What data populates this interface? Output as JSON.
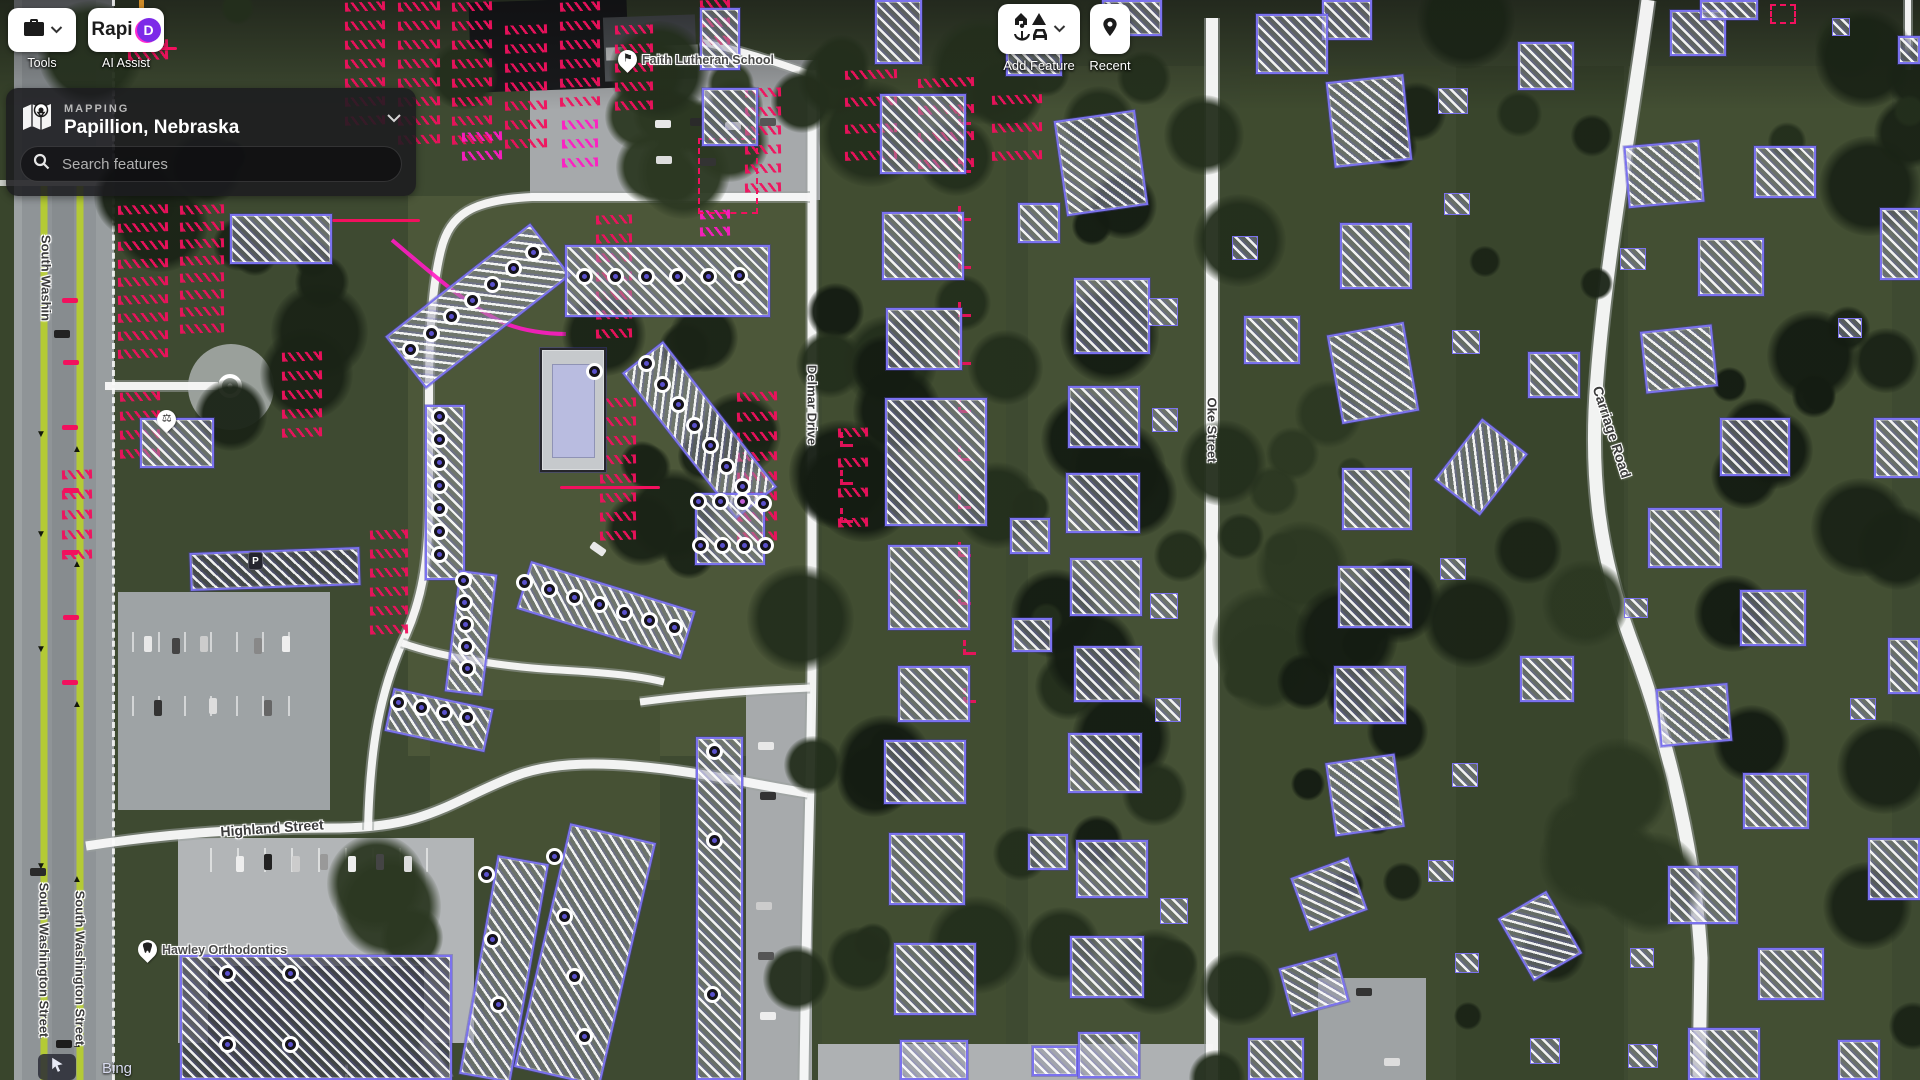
{
  "toolbar": {
    "tools": {
      "label": "Tools"
    },
    "rapid": {
      "logo_text": "Rapi",
      "logo_d": "D",
      "label": "AI Assist"
    },
    "add_feature": {
      "label": "Add Feature"
    },
    "recent": {
      "label": "Recent"
    }
  },
  "panel": {
    "section": "MAPPING",
    "title": "Papillion, Nebraska",
    "search_placeholder": "Search features"
  },
  "attribution": {
    "source": "Bing"
  },
  "map": {
    "colors": {
      "osm_purple": "#7b72ee",
      "ai_red": "#f1115e",
      "ai_magenta": "#ff1cc3",
      "node_fill": "#5a50cc",
      "road_lime": "#b6cc2f",
      "road_white": "#f8f8f8"
    },
    "street_labels": [
      {
        "text": "South Washin",
        "x": 46,
        "y": 278,
        "rot": 90,
        "size": 13
      },
      {
        "text": "South Washington Street",
        "x": 44,
        "y": 960,
        "rot": 90,
        "size": 13
      },
      {
        "text": "South Washington Street",
        "x": 80,
        "y": 968,
        "rot": 90,
        "size": 13
      },
      {
        "text": "Highland Street",
        "x": 272,
        "y": 828,
        "rot": -4,
        "size": 14
      },
      {
        "text": "Delmar Drive",
        "x": 812,
        "y": 405,
        "rot": 90,
        "size": 13
      },
      {
        "text": "Oke Street",
        "x": 1212,
        "y": 430,
        "rot": 90,
        "size": 13
      },
      {
        "text": "Carriage Road",
        "x": 1612,
        "y": 432,
        "rot": 72,
        "size": 14
      }
    ],
    "pois": [
      {
        "label": "Faith Lutheran School",
        "x": 618,
        "y": 50,
        "icon": "school"
      },
      {
        "label": "Hawley Orthodontics",
        "x": 138,
        "y": 940,
        "icon": "tooth"
      },
      {
        "label": "",
        "x": 157,
        "y": 410,
        "icon": "scales"
      },
      {
        "label": "P",
        "x": 248,
        "y": 552,
        "icon": "parking"
      }
    ],
    "roads": [
      {
        "name": "delmar-drive",
        "d": "M812,70 L812,650 C812,760 806,900 804,1080",
        "w": 9
      },
      {
        "name": "oke-street",
        "d": "M1212,18 L1212,1080",
        "w": 12
      },
      {
        "name": "carriage-road",
        "d": "M1648,0 C1632,120 1606,258 1597,378 C1589,478 1599,556 1633,646 C1669,742 1696,858 1701,958 L1699,1080",
        "w": 13
      },
      {
        "name": "highland-street",
        "d": "M86,846 C170,833 250,828 340,828 C430,827 452,800 515,776 C562,758 625,764 672,770 C732,778 772,788 808,793",
        "w": 9
      },
      {
        "name": "complex-loop",
        "d": "M810,197 L532,197 C472,200 450,214 441,250 C433,282 429,330 429,392 L429,500 C429,560 422,602 402,643 C381,692 370,742 368,830",
        "w": 8
      },
      {
        "name": "entrance-road",
        "d": "M105,386 L218,386",
        "w": 8
      },
      {
        "name": "lot-entrance",
        "d": "M640,702 C700,694 760,690 810,688",
        "w": 7
      },
      {
        "name": "complex-cross",
        "d": "M402,643 C450,660 520,668 560,670 C610,673 640,676 664,682",
        "w": 7
      },
      {
        "name": "south-road",
        "d": "M398,1012 C418,1036 436,1060 446,1080",
        "w": 13
      },
      {
        "name": "school-stub",
        "d": "M812,75 C770,60 740,50 700,42",
        "w": 7
      },
      {
        "name": "edge-road",
        "d": "M1908,0 L1908,70",
        "w": 6
      }
    ],
    "lime_lines": [
      {
        "d": "M44,186 L44,1080",
        "w": 7
      },
      {
        "d": "M80,186 L80,1080",
        "w": 7
      }
    ],
    "magenta_lines": [
      {
        "d": "M392,240 C430,272 468,306 502,322 C522,331 548,334 566,334",
        "w": 4
      }
    ],
    "roundabout": {
      "cx": 230,
      "cy": 386,
      "r": 10
    },
    "buildings": [
      [
        386,
        273,
        184,
        66,
        -38,
        "b"
      ],
      [
        565,
        245,
        205,
        72,
        0,
        "b"
      ],
      [
        425,
        405,
        40,
        175,
        0,
        "b"
      ],
      [
        607,
        404,
        185,
        52,
        52,
        "b"
      ],
      [
        695,
        493,
        70,
        72,
        0,
        "bn"
      ],
      [
        452,
        572,
        38,
        122,
        7,
        "b"
      ],
      [
        520,
        585,
        172,
        50,
        17,
        "b"
      ],
      [
        388,
        698,
        102,
        44,
        12,
        "b"
      ],
      [
        696,
        737,
        47,
        343,
        0,
        "b"
      ],
      [
        541,
        830,
        88,
        250,
        13,
        "b"
      ],
      [
        478,
        858,
        52,
        222,
        10,
        "b"
      ],
      [
        180,
        955,
        272,
        125,
        0,
        "b roof"
      ],
      [
        190,
        550,
        170,
        38,
        -2,
        "b roof"
      ],
      [
        230,
        214,
        102,
        50,
        0,
        "b"
      ],
      [
        140,
        418,
        74,
        50,
        0,
        "b"
      ],
      [
        875,
        0,
        47,
        64,
        0,
        "bp"
      ],
      [
        700,
        8,
        40,
        62,
        0,
        "bp"
      ],
      [
        702,
        88,
        56,
        58,
        0,
        "b"
      ],
      [
        540,
        348,
        66,
        124,
        0,
        "pool"
      ],
      [
        880,
        94,
        86,
        80,
        0,
        "b"
      ],
      [
        882,
        212,
        82,
        68,
        0,
        "b"
      ],
      [
        886,
        308,
        76,
        62,
        0,
        "b"
      ],
      [
        885,
        398,
        102,
        128,
        0,
        "bp"
      ],
      [
        888,
        545,
        82,
        85,
        0,
        "bp"
      ],
      [
        898,
        666,
        72,
        56,
        0,
        "b"
      ],
      [
        884,
        740,
        82,
        64,
        0,
        "b"
      ],
      [
        889,
        833,
        76,
        72,
        0,
        "b"
      ],
      [
        894,
        943,
        82,
        72,
        0,
        "b"
      ],
      [
        900,
        1040,
        68,
        40,
        0,
        "b"
      ],
      [
        1006,
        28,
        56,
        48,
        0,
        "b"
      ],
      [
        1018,
        203,
        42,
        40,
        0,
        "b"
      ],
      [
        1010,
        518,
        40,
        36,
        0,
        "b"
      ],
      [
        1012,
        618,
        40,
        34,
        0,
        "b"
      ],
      [
        1028,
        834,
        40,
        36,
        0,
        "b"
      ],
      [
        1032,
        1046,
        46,
        30,
        0,
        "b"
      ],
      [
        1060,
        115,
        82,
        96,
        -8,
        "b"
      ],
      [
        1074,
        278,
        76,
        76,
        0,
        "b"
      ],
      [
        1068,
        386,
        72,
        62,
        0,
        "b"
      ],
      [
        1066,
        473,
        74,
        60,
        0,
        "b"
      ],
      [
        1070,
        558,
        72,
        58,
        0,
        "b"
      ],
      [
        1074,
        646,
        68,
        56,
        0,
        "b"
      ],
      [
        1068,
        733,
        74,
        60,
        0,
        "b"
      ],
      [
        1076,
        840,
        72,
        58,
        0,
        "b"
      ],
      [
        1070,
        936,
        74,
        62,
        0,
        "b"
      ],
      [
        1078,
        1032,
        62,
        46,
        0,
        "b"
      ],
      [
        1148,
        298,
        30,
        28,
        0,
        "b sh"
      ],
      [
        1152,
        408,
        26,
        24,
        0,
        "b sh"
      ],
      [
        1150,
        593,
        28,
        26,
        0,
        "b sh"
      ],
      [
        1155,
        698,
        26,
        24,
        0,
        "b sh"
      ],
      [
        1160,
        898,
        28,
        26,
        0,
        "b sh"
      ],
      [
        1102,
        0,
        60,
        36,
        0,
        "b"
      ],
      [
        1322,
        0,
        50,
        40,
        0,
        "b"
      ],
      [
        1256,
        14,
        72,
        60,
        0,
        "b"
      ],
      [
        1330,
        78,
        78,
        86,
        -6,
        "b"
      ],
      [
        1340,
        223,
        72,
        66,
        0,
        "b"
      ],
      [
        1244,
        316,
        56,
        48,
        0,
        "b"
      ],
      [
        1334,
        328,
        78,
        90,
        -10,
        "b"
      ],
      [
        1342,
        468,
        70,
        62,
        0,
        "b"
      ],
      [
        1338,
        566,
        74,
        62,
        0,
        "b"
      ],
      [
        1334,
        666,
        72,
        58,
        0,
        "b"
      ],
      [
        1330,
        758,
        70,
        74,
        -8,
        "b"
      ],
      [
        1298,
        866,
        62,
        56,
        -20,
        "b"
      ],
      [
        1284,
        960,
        60,
        50,
        -15,
        "b"
      ],
      [
        1248,
        1038,
        56,
        42,
        0,
        "b"
      ],
      [
        1232,
        236,
        26,
        24,
        0,
        "b sh"
      ],
      [
        1438,
        88,
        30,
        26,
        0,
        "b sh"
      ],
      [
        1444,
        193,
        26,
        22,
        0,
        "b sh"
      ],
      [
        1452,
        330,
        28,
        24,
        0,
        "b sh"
      ],
      [
        1440,
        558,
        26,
        22,
        0,
        "b sh"
      ],
      [
        1452,
        763,
        26,
        24,
        0,
        "b sh"
      ],
      [
        1428,
        860,
        26,
        22,
        0,
        "b sh"
      ],
      [
        1455,
        953,
        24,
        20,
        0,
        "b sh"
      ],
      [
        1530,
        1038,
        30,
        26,
        0,
        "b sh"
      ],
      [
        1452,
        428,
        58,
        78,
        38,
        "b"
      ],
      [
        1518,
        42,
        56,
        48,
        0,
        "b"
      ],
      [
        1528,
        352,
        52,
        46,
        0,
        "b"
      ],
      [
        1520,
        656,
        54,
        46,
        0,
        "b"
      ],
      [
        1512,
        900,
        56,
        72,
        -30,
        "b"
      ],
      [
        1670,
        10,
        56,
        46,
        0,
        "b"
      ],
      [
        1700,
        0,
        58,
        20,
        0,
        "b"
      ],
      [
        1832,
        18,
        18,
        18,
        0,
        "b sh"
      ],
      [
        1898,
        36,
        22,
        28,
        0,
        "b"
      ],
      [
        1626,
        143,
        76,
        62,
        -5,
        "b"
      ],
      [
        1754,
        146,
        62,
        52,
        0,
        "b"
      ],
      [
        1698,
        238,
        66,
        58,
        0,
        "b"
      ],
      [
        1643,
        328,
        72,
        62,
        -6,
        "b"
      ],
      [
        1720,
        418,
        70,
        58,
        0,
        "b"
      ],
      [
        1648,
        508,
        74,
        60,
        0,
        "b"
      ],
      [
        1740,
        590,
        66,
        56,
        0,
        "b"
      ],
      [
        1658,
        686,
        72,
        58,
        -5,
        "b"
      ],
      [
        1743,
        773,
        66,
        56,
        0,
        "b"
      ],
      [
        1668,
        866,
        70,
        58,
        0,
        "b"
      ],
      [
        1758,
        948,
        66,
        52,
        0,
        "b"
      ],
      [
        1688,
        1028,
        72,
        52,
        0,
        "b"
      ],
      [
        1880,
        208,
        40,
        72,
        0,
        "b"
      ],
      [
        1874,
        418,
        46,
        60,
        0,
        "b"
      ],
      [
        1888,
        638,
        32,
        56,
        0,
        "b"
      ],
      [
        1868,
        838,
        52,
        62,
        0,
        "b"
      ],
      [
        1838,
        1040,
        42,
        40,
        0,
        "b"
      ],
      [
        1620,
        248,
        26,
        22,
        0,
        "b sh"
      ],
      [
        1838,
        318,
        24,
        20,
        0,
        "b sh"
      ],
      [
        1624,
        598,
        24,
        20,
        0,
        "b sh"
      ],
      [
        1850,
        698,
        26,
        22,
        0,
        "b sh"
      ],
      [
        1630,
        948,
        24,
        20,
        0,
        "b sh"
      ],
      [
        1628,
        1044,
        30,
        24,
        0,
        "b sh"
      ]
    ],
    "nodes": [
      [
        416,
        355
      ],
      [
        437,
        339
      ],
      [
        457,
        322
      ],
      [
        478,
        306
      ],
      [
        498,
        290
      ],
      [
        519,
        274
      ],
      [
        539,
        258
      ],
      [
        590,
        282
      ],
      [
        621,
        282
      ],
      [
        652,
        282
      ],
      [
        683,
        282
      ],
      [
        714,
        282
      ],
      [
        745,
        281
      ],
      [
        445,
        422
      ],
      [
        445,
        445
      ],
      [
        445,
        468
      ],
      [
        445,
        491
      ],
      [
        445,
        514
      ],
      [
        445,
        537
      ],
      [
        445,
        560
      ],
      [
        652,
        369
      ],
      [
        668,
        390
      ],
      [
        684,
        410
      ],
      [
        700,
        431
      ],
      [
        716,
        451
      ],
      [
        732,
        472
      ],
      [
        748,
        492
      ],
      [
        704,
        507
      ],
      [
        726,
        507
      ],
      [
        748,
        507,
        1
      ],
      [
        769,
        509
      ],
      [
        706,
        551
      ],
      [
        728,
        551
      ],
      [
        750,
        551
      ],
      [
        771,
        551
      ],
      [
        469,
        586
      ],
      [
        470,
        608
      ],
      [
        471,
        630
      ],
      [
        472,
        652
      ],
      [
        473,
        674
      ],
      [
        530,
        588
      ],
      [
        555,
        595
      ],
      [
        580,
        603
      ],
      [
        605,
        610
      ],
      [
        630,
        618
      ],
      [
        655,
        626
      ],
      [
        680,
        633
      ],
      [
        404,
        708
      ],
      [
        427,
        713
      ],
      [
        450,
        718
      ],
      [
        473,
        723
      ],
      [
        720,
        757
      ],
      [
        720,
        846
      ],
      [
        718,
        1000
      ],
      [
        560,
        862
      ],
      [
        570,
        922
      ],
      [
        580,
        982
      ],
      [
        590,
        1042
      ],
      [
        492,
        880
      ],
      [
        498,
        945
      ],
      [
        504,
        1010
      ],
      [
        233,
        979
      ],
      [
        296,
        979
      ],
      [
        233,
        1050
      ],
      [
        296,
        1050
      ],
      [
        600,
        377
      ]
    ],
    "red_rows": [
      [
        118,
        205,
        9,
        50,
        18
      ],
      [
        180,
        205,
        8,
        44,
        17
      ],
      [
        345,
        2,
        7,
        40,
        19
      ],
      [
        398,
        2,
        8,
        42,
        19
      ],
      [
        452,
        2,
        8,
        40,
        19
      ],
      [
        505,
        25,
        7,
        42,
        19
      ],
      [
        560,
        2,
        6,
        40,
        19
      ],
      [
        615,
        25,
        5,
        38,
        19
      ],
      [
        596,
        215,
        7,
        36,
        19
      ],
      [
        745,
        88,
        6,
        36,
        19
      ],
      [
        737,
        392,
        8,
        40,
        20
      ],
      [
        600,
        398,
        8,
        36,
        19
      ],
      [
        370,
        530,
        6,
        38,
        19
      ],
      [
        845,
        70,
        4,
        52,
        27
      ],
      [
        918,
        78,
        4,
        56,
        27
      ],
      [
        992,
        95,
        3,
        50,
        28
      ],
      [
        838,
        428,
        4,
        30,
        30
      ],
      [
        282,
        352,
        5,
        40,
        19
      ],
      [
        120,
        392,
        4,
        40,
        19
      ],
      [
        62,
        470,
        5,
        30,
        20
      ],
      [
        700,
        0,
        3,
        30,
        18
      ],
      [
        128,
        40,
        2,
        40,
        11
      ]
    ],
    "magenta_rows": [
      [
        562,
        120,
        3,
        36,
        19
      ],
      [
        462,
        132,
        2,
        40,
        19
      ],
      [
        700,
        210,
        2,
        30,
        17
      ]
    ],
    "red_ticks": [
      [
        958,
        110
      ],
      [
        958,
        158
      ],
      [
        958,
        206
      ],
      [
        958,
        254
      ],
      [
        958,
        302
      ],
      [
        958,
        350
      ],
      [
        958,
        398
      ],
      [
        958,
        446
      ],
      [
        958,
        494
      ],
      [
        958,
        542
      ],
      [
        958,
        590
      ],
      [
        963,
        640
      ],
      [
        963,
        688
      ],
      [
        840,
        432
      ],
      [
        840,
        470
      ],
      [
        840,
        508
      ]
    ],
    "red_small_dashes": [
      [
        62,
        298
      ],
      [
        63,
        360
      ],
      [
        62,
        425
      ],
      [
        63,
        488
      ],
      [
        62,
        550
      ],
      [
        63,
        615
      ],
      [
        62,
        680
      ]
    ],
    "red_lines": [
      [
        332,
        219,
        88,
        3
      ],
      [
        133,
        47,
        44,
        3
      ],
      [
        560,
        486,
        100,
        3
      ]
    ],
    "red_dashed_rects": [
      [
        698,
        138,
        60,
        76
      ],
      [
        1770,
        4,
        26,
        20
      ]
    ]
  }
}
